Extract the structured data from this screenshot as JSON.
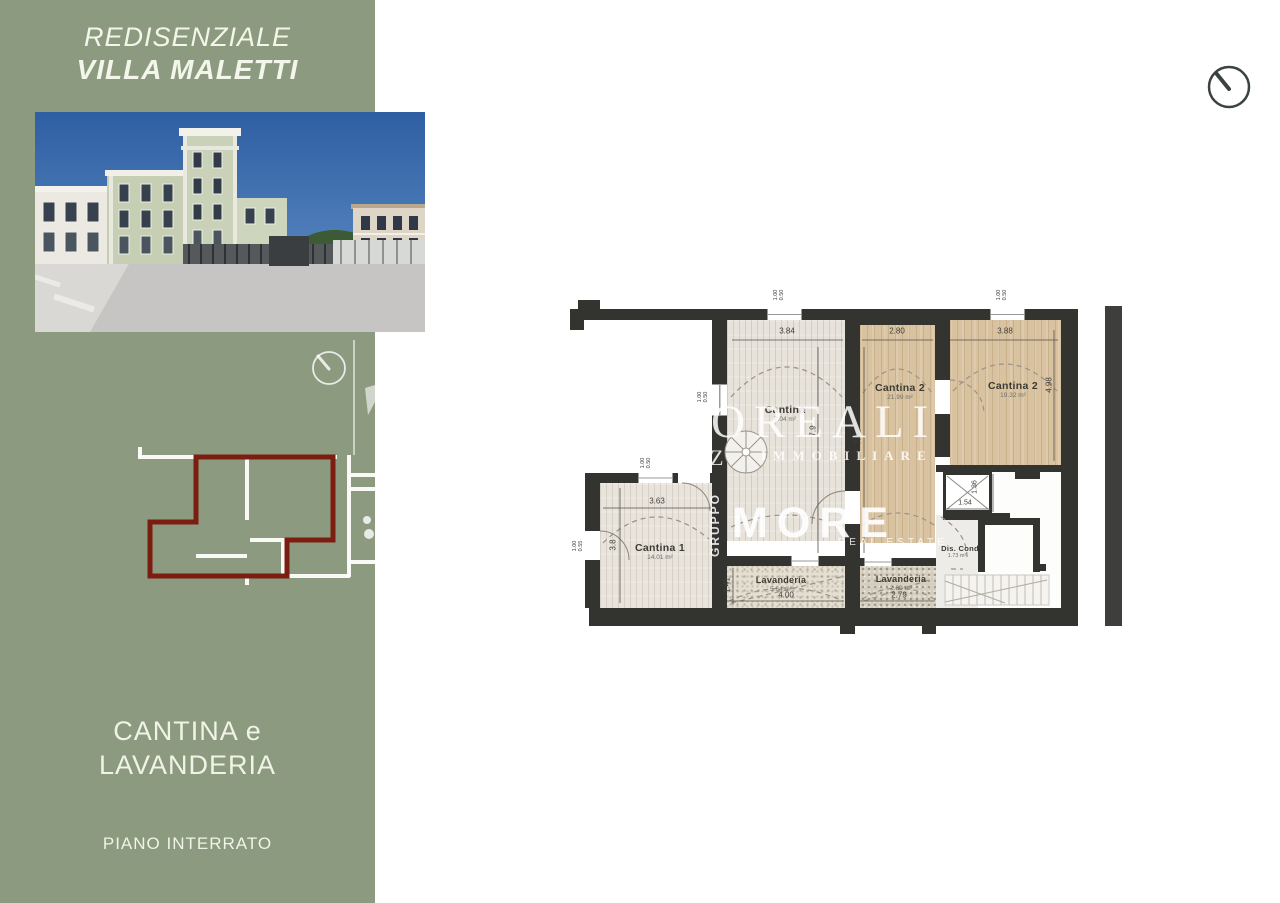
{
  "header": {
    "subtitle": "REDISENZIALE",
    "title": "VILLA MALETTI"
  },
  "sidebar": {
    "caption_line1": "CANTINA e",
    "caption_line2": "LAVANDERIA",
    "floor_label": "PIANO INTERRATO"
  },
  "watermark": {
    "brand": "OREALI",
    "brand_fragment": "Z",
    "brand_sub": "IMMOBILIARE",
    "brand2": "MORE",
    "brand2_sub": "REAL ESTATE",
    "vertical_label": "GRUPPO"
  },
  "plan": {
    "rooms": {
      "cantina_mid": {
        "label": "Cantina",
        "area": "7.04 m²"
      },
      "cantina2a": {
        "label": "Cantina 2",
        "area": "21.99 m²"
      },
      "cantina2b": {
        "label": "Cantina 2",
        "area": "19.32 m²"
      },
      "cantina1": {
        "label": "Cantina 1",
        "area": "14.01 m²"
      },
      "lavanderia1": {
        "label": "Lavanderia",
        "area": "5.64 m²"
      },
      "lavanderia2": {
        "label": "Lavanderia",
        "area": "2.60 m²"
      },
      "dis_cond": {
        "label": "Dis. Cond",
        "area": "1.73 m²"
      }
    },
    "dims": {
      "w_cantina_mid": "3.84",
      "w_cantina2a": "2.80",
      "w_cantina2b": "3.88",
      "h_cantina_mid": "7.9",
      "h_cantina2a": "7.62",
      "h_cantina2b": "4.98",
      "w_cantina1": "3.63",
      "h_cantina1": "3.8",
      "h_lavanderia1": "1.41",
      "w_lavanderia1": "4.00",
      "w_lavanderia2": "2.79",
      "w_elevator": "1.54",
      "h_elevator": "1.36"
    },
    "opening_dims": [
      {
        "a": "1.00",
        "b": "0.50"
      },
      {
        "a": "1.00",
        "b": "0.50"
      },
      {
        "a": "1.00",
        "b": "0.50"
      },
      {
        "a": "1.00",
        "b": "0.50"
      },
      {
        "a": "1.00",
        "b": "0.55"
      }
    ]
  },
  "icons": {
    "top_right": "clock-icon",
    "sidebar_badge": "clock-icon"
  },
  "colors": {
    "sidebar_green": "#8c9a7f",
    "highlight_maroon": "#7c1d12",
    "wall_dark": "#333330",
    "room_wood": "#d9c2a0",
    "sky_blue": "#2f5fa3"
  }
}
